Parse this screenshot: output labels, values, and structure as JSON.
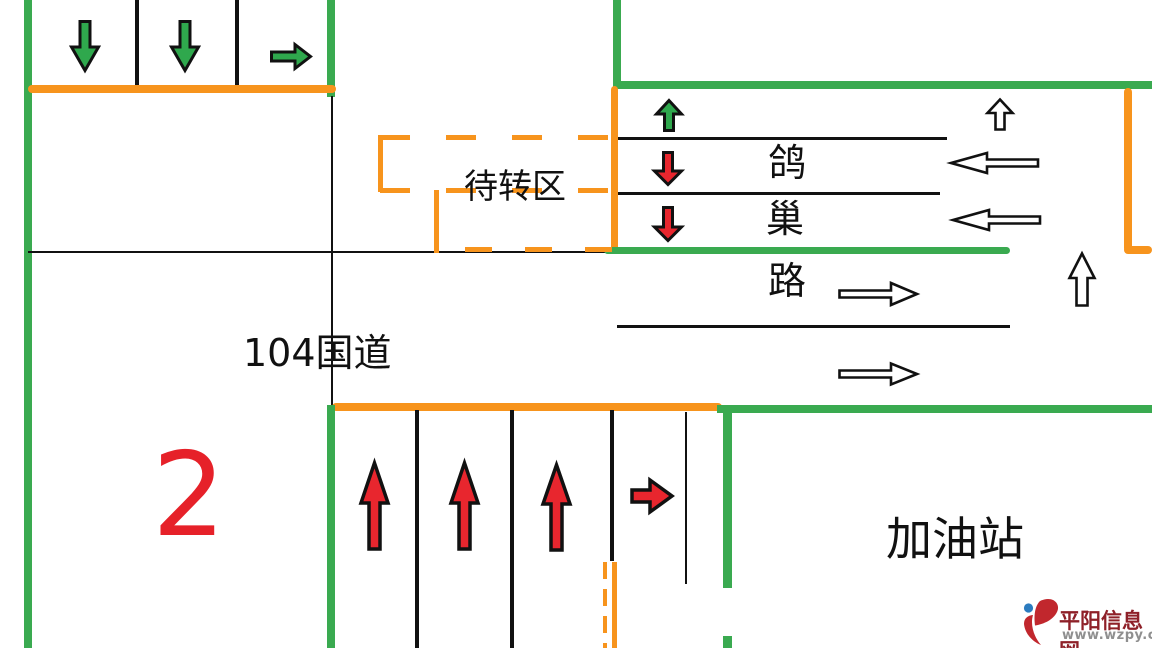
{
  "diagram": {
    "waiting_zone_label": "待转区",
    "highway_label": "104国道",
    "cross_road_name_chars": [
      "鸽",
      "巢",
      "路"
    ],
    "gas_station_label": "加油站",
    "figure_number": "2"
  },
  "watermark": {
    "site_name": "平阳信息网",
    "site_url": "www.wzpy.com"
  },
  "colors": {
    "road_green": "#3aaa50",
    "stop_orange": "#f7941d",
    "arrow_red": "#e8262e",
    "arrow_green": "#2fa84d",
    "number_red": "#e62129",
    "lane_black": "#111111",
    "wm_red": "#8e2028",
    "wm_gray": "#8f8f8f",
    "wm_blue": "#2b7bbf"
  },
  "icons": {
    "green-down-arrow": "⬇",
    "green-right-arrow": "➡",
    "green-up-arrow": "⬆",
    "red-down-arrow": "⬇",
    "red-up-arrow": "⬆",
    "red-right-arrow": "➡",
    "white-up-arrow": "⇧",
    "white-left-arrow": "⇦",
    "white-right-arrow": "⇨",
    "site-logo": "平阳信息网-logo"
  }
}
